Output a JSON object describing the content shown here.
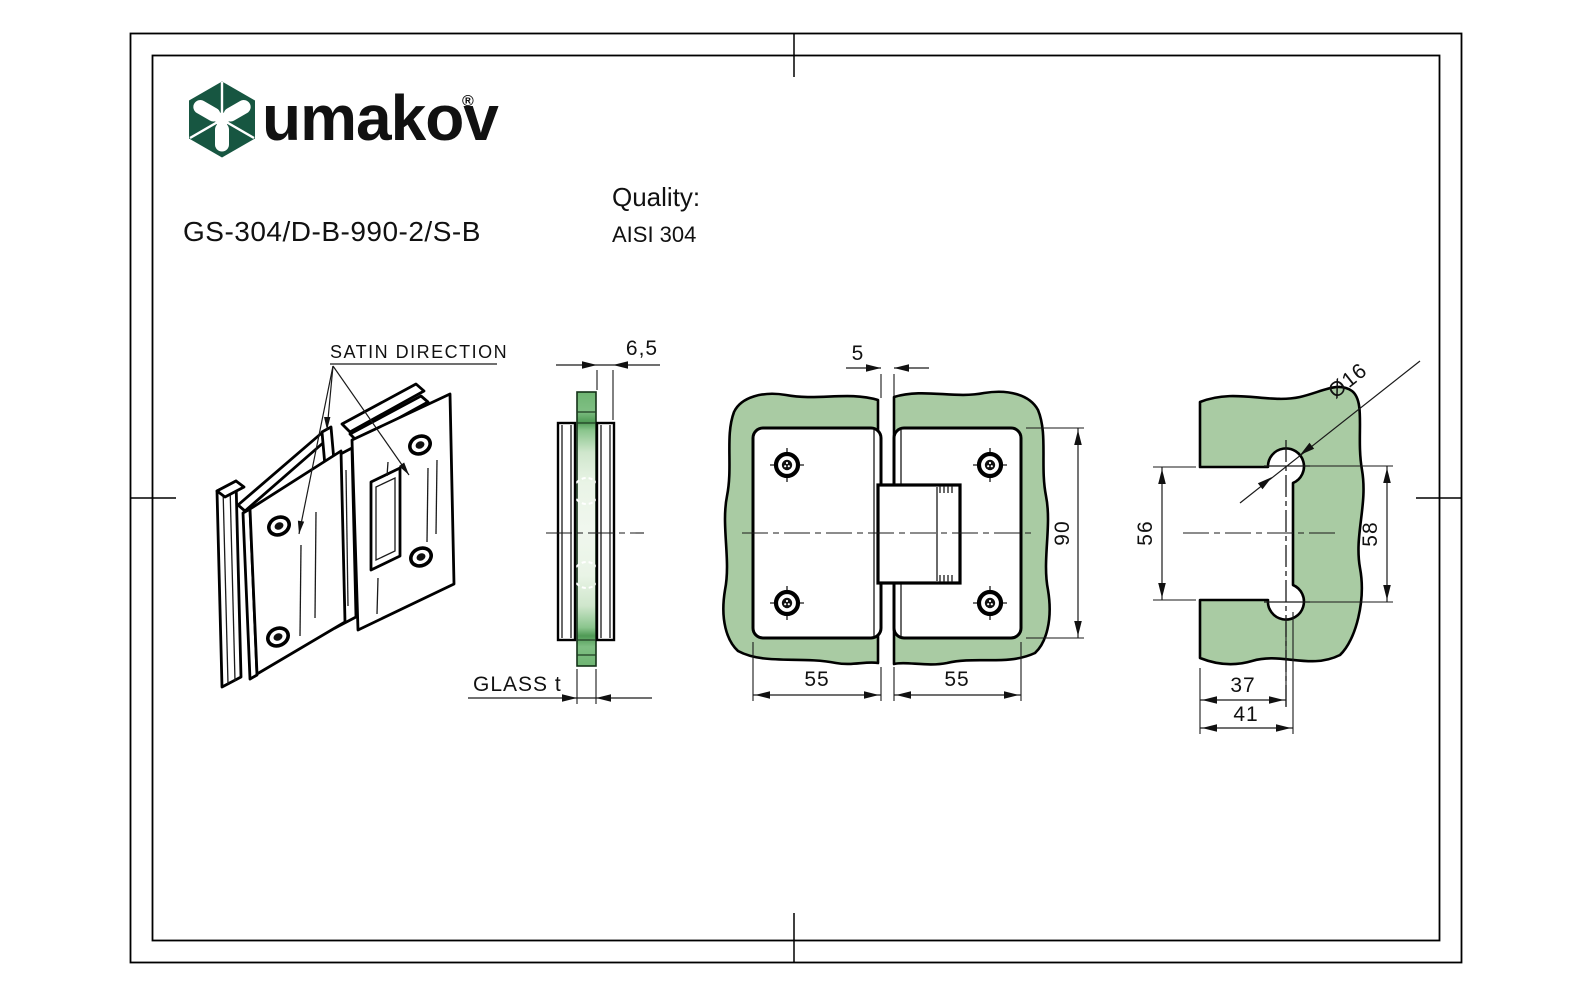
{
  "sheet": {
    "background_color": "#ffffff",
    "frame_color": "#000000"
  },
  "header": {
    "brand": "umakov",
    "registered_mark": "®",
    "brand_color": "#175641",
    "part_number": "GS-304/D-B-990-2/S-B",
    "quality_label": "Quality:",
    "quality_value": "AISI 304"
  },
  "drawing": {
    "glass_color": "#a9cba3",
    "glass_edge_color": "#6fb573",
    "line_color": "#000000",
    "views": {
      "isometric": {
        "satin_label": "SATIN DIRECTION"
      },
      "side_section": {
        "hinge_thickness": "6,5",
        "glass_label": "GLASS t"
      },
      "front": {
        "glass_gap": "5",
        "hinge_height": "90",
        "left_leaf_width": "55",
        "right_leaf_width": "55"
      },
      "drilling_template": {
        "hole_diameter": "Ø16",
        "cutout_height": "56",
        "hole_spacing": "58",
        "hole_offset": "37",
        "cutout_width": "41"
      }
    }
  }
}
